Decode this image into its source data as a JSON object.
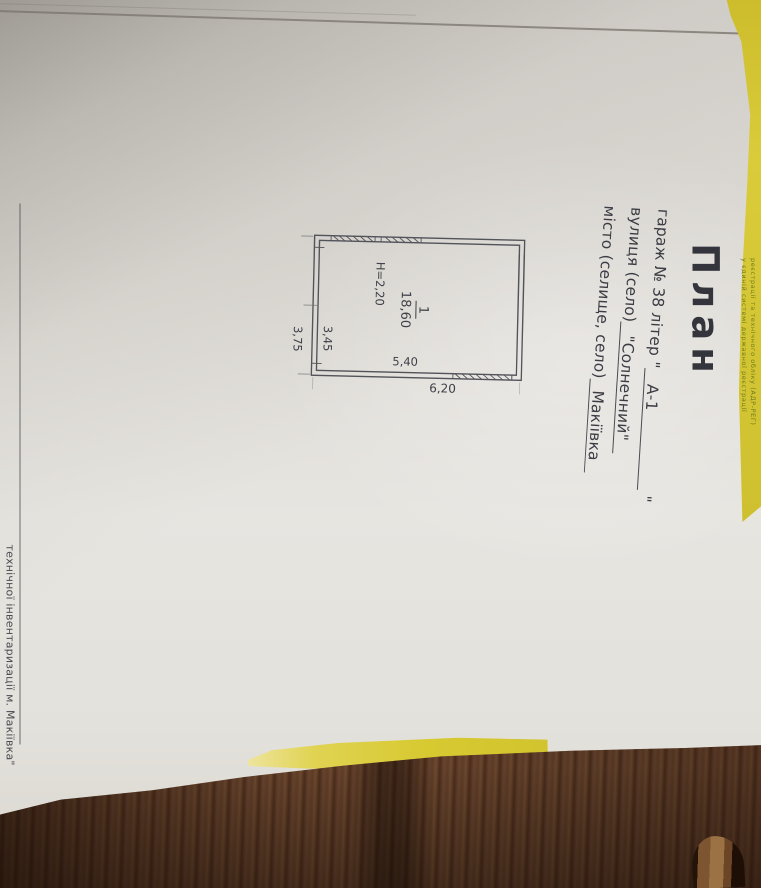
{
  "document": {
    "title": "План",
    "lines": [
      {
        "label": "гараж № 38 літер \"",
        "value": "А-1",
        "suffix": "\""
      },
      {
        "label": "вулиця (село)",
        "value": "\"Солнечний\"",
        "suffix": ""
      },
      {
        "label": "місто (селище, село)",
        "value": "Макіївка",
        "suffix": ""
      }
    ],
    "plan": {
      "room_number": "1",
      "room_area": "18,60",
      "height": "H=2,20",
      "inner_width": "3,45",
      "inner_length": "5,40",
      "outer_length": "6,20",
      "outer_width": "3,75"
    },
    "footer": "технічної інвентаризації м. Макіївка\""
  },
  "folder": {
    "microtext_line1": "реєстрації та технічного обліку (АДР-РЕГ)",
    "microtext_line2": "у єдиній системі державної реєстрації"
  },
  "colors": {
    "folder_yellow": "#d7c832",
    "page_light": "#e9e7e2",
    "page_shadow": "#aba69f",
    "ink": "#3b3c44",
    "wood_dark": "#4c2d1a"
  }
}
